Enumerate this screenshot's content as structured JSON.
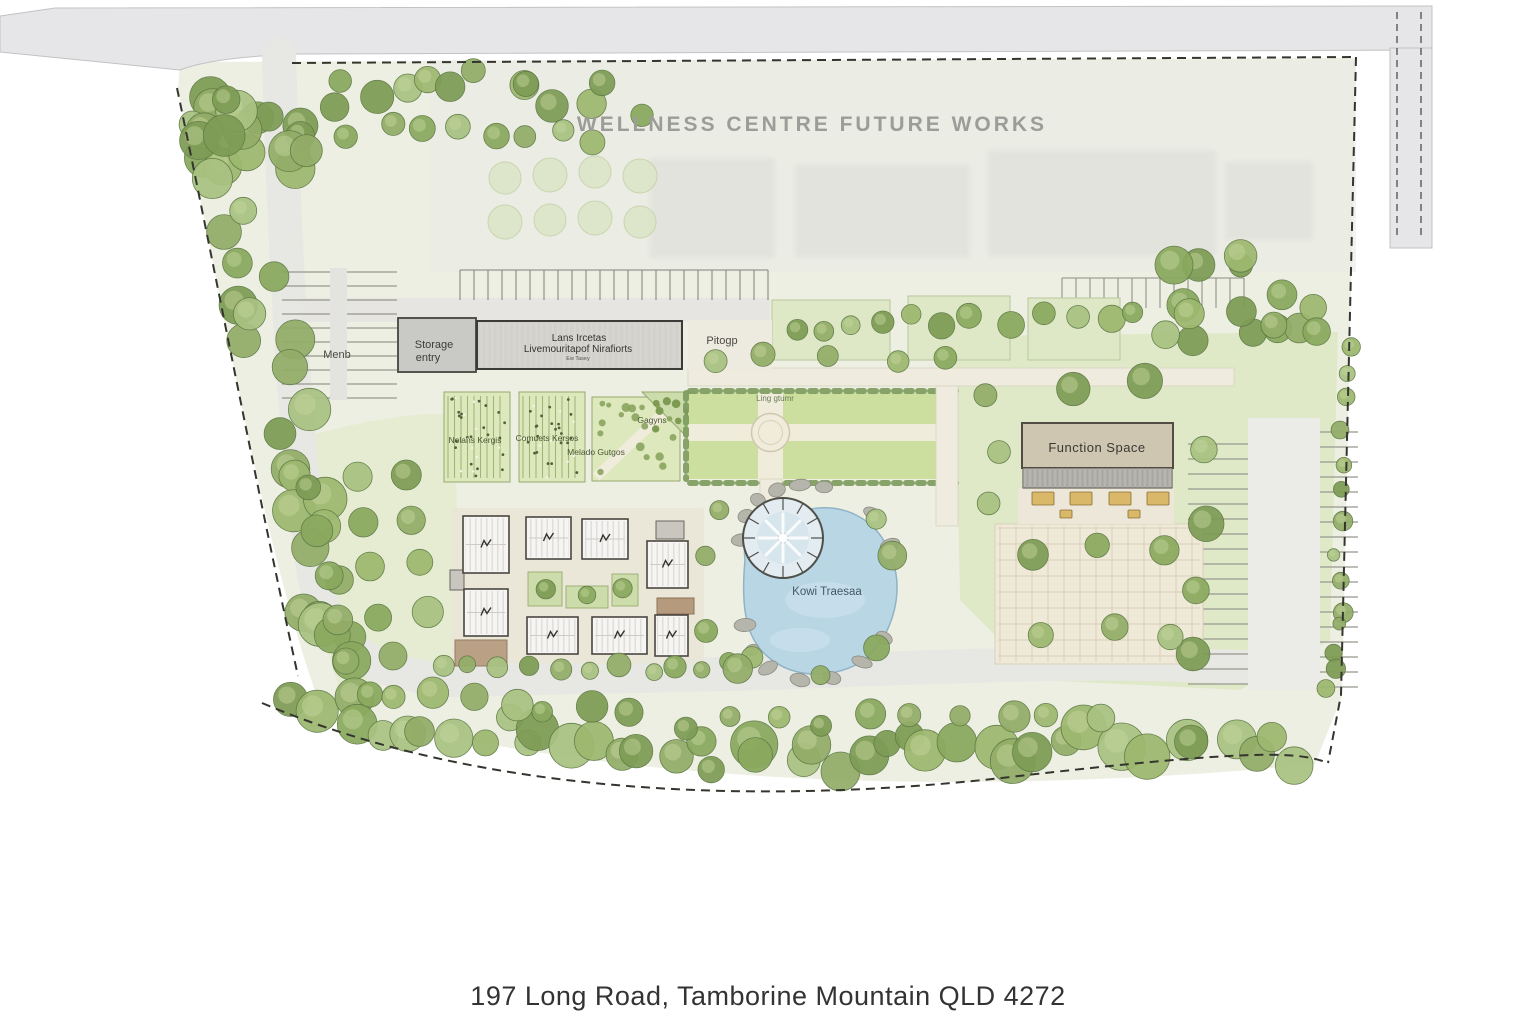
{
  "title": {
    "future_works": "WELLNESS CENTRE FUTURE WORKS"
  },
  "buildings": {
    "storage_line1": "Storage",
    "storage_line2": "entry",
    "main_line1": "Lans Ircetas",
    "main_line2": "Livemouritapof Nirafiorts",
    "main_line3": "Ew Tasey",
    "function_space": "Function Space"
  },
  "grounds": {
    "west_parking": "Menb",
    "drop_off": "Pitogp",
    "plot_a": "Nolans Kergis",
    "plot_b": "Comuets Kersos",
    "plot_c": "Melado Gutgos",
    "plot_d": "Gagyns",
    "lawn_note": "Ling gtumr",
    "pond": "Kowi Traesaa"
  },
  "footer": {
    "address": "197 Long Road, Tamborine Mountain QLD 4272"
  },
  "colors": {
    "boundary_dash": "#35352f",
    "road": "#e6e6e8",
    "site_wash": "#edefe2",
    "lawn": "#ccdf9f",
    "pond": "#b9d6e5",
    "paving": "#efe9d8",
    "building_grey": "#d3d1cb",
    "function_tan": "#cfc6b1",
    "cabin_white": "#f6f5f3",
    "tree_green": "#8aa95e",
    "future_text_grey": "#9c9c98",
    "caption_text": "#333333"
  }
}
